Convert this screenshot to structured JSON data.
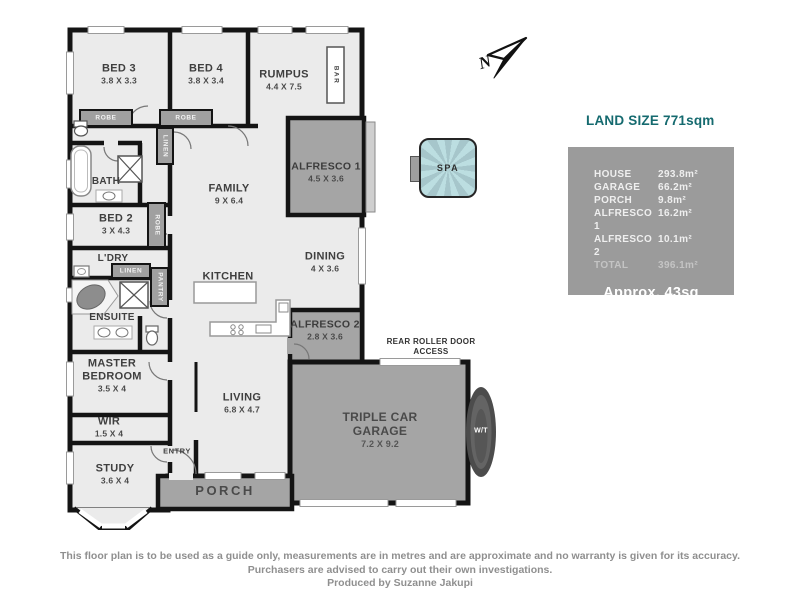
{
  "plan": {
    "rooms": {
      "bed3": {
        "name": "BED 3",
        "dims": "3.8 X 3.3"
      },
      "bed4": {
        "name": "BED 4",
        "dims": "3.8 X 3.4"
      },
      "rumpus": {
        "name": "RUMPUS",
        "dims": "4.4 X 7.5"
      },
      "family": {
        "name": "FAMILY",
        "dims": "9 X 6.4"
      },
      "alfresco1": {
        "name": "ALFRESCO 1",
        "dims": "4.5 X 3.6"
      },
      "dining": {
        "name": "DINING",
        "dims": "4 X 3.6"
      },
      "kitchen": {
        "name": "KITCHEN"
      },
      "bath": {
        "name": "BATH"
      },
      "bed2": {
        "name": "BED 2",
        "dims": "3 X 4.3"
      },
      "ldry": {
        "name": "L'DRY"
      },
      "ensuite": {
        "name": "ENSUITE"
      },
      "master": {
        "name": "MASTER BEDROOM",
        "dims": "3.5 X 4"
      },
      "wir": {
        "name": "WIR",
        "dims": "1.5 X 4"
      },
      "study": {
        "name": "STUDY",
        "dims": "3.6 X 4"
      },
      "entry": {
        "name": "ENTRY"
      },
      "living": {
        "name": "LIVING",
        "dims": "6.8 X 4.7"
      },
      "porch": {
        "name": "PORCH"
      },
      "alfresco2": {
        "name": "ALFRESCO 2",
        "dims": "2.8 X 3.6"
      },
      "garage": {
        "name": "TRIPLE CAR GARAGE",
        "dims": "7.2 X 9.2"
      }
    },
    "features": {
      "bar": "BAR",
      "spa": "SPA",
      "water_tank": "W/T",
      "rear_roller": "REAR ROLLER DOOR ACCESS",
      "robe": "ROBE",
      "linen": "LINEN",
      "pantry": "PANTRY",
      "north": "N"
    }
  },
  "land_size_title": "LAND SIZE 771sqm",
  "areas": {
    "rows": [
      {
        "label": "HOUSE",
        "value": "293.8m²"
      },
      {
        "label": "GARAGE",
        "value": "66.2m²"
      },
      {
        "label": "PORCH",
        "value": "9.8m²"
      },
      {
        "label": "ALFRESCO 1",
        "value": "16.2m²"
      },
      {
        "label": "ALFRESCO 2",
        "value": "10.1m²"
      },
      {
        "label": "TOTAL",
        "value": "396.1m²"
      }
    ],
    "approx": "Approx. 43sq"
  },
  "disclaimer": {
    "line1": "This floor plan is to be used as a guide only, measurements are in metres and are approximate and no warranty is given for its accuracy.",
    "line2": "Purchasers are advised to carry out their own investigations.",
    "line3": "Produced by Suzanne Jakupi"
  },
  "colors": {
    "accent_teal": "#156a6f",
    "wall": "#141414",
    "interior": "#ebebeb",
    "exterior_gray": "#a5a5a5",
    "panel_gray": "#9b9b9b",
    "spa_blue": "#b9dce0",
    "disclaimer_gray": "#8f8f8f"
  }
}
